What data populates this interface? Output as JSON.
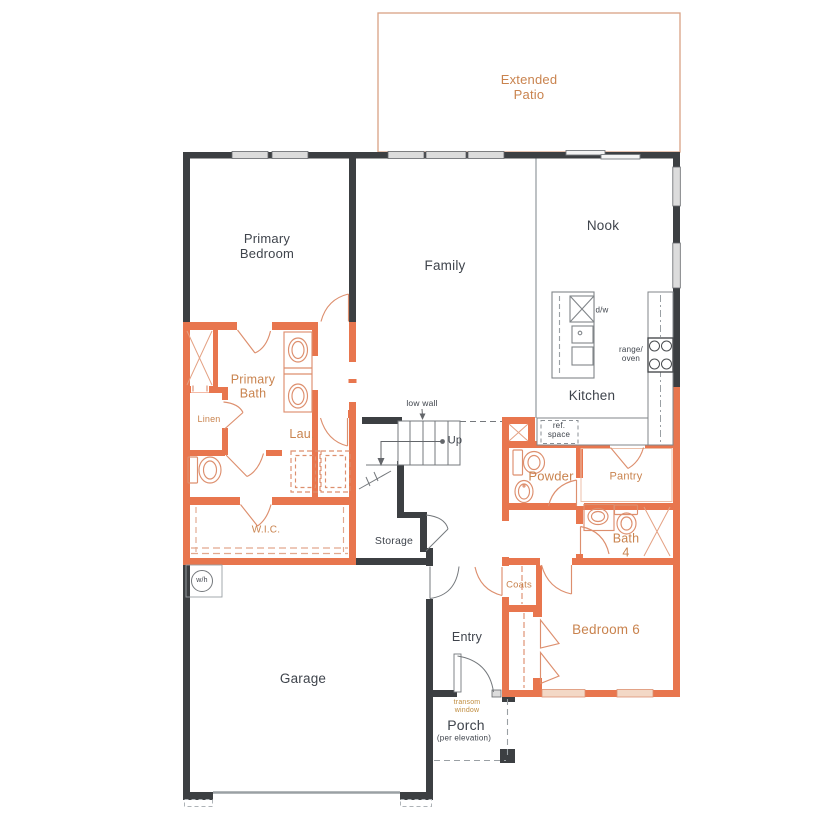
{
  "title": "Single-story floor plan",
  "colors": {
    "wall_dark": "#3c3f42",
    "wall_accent": "#e8764e",
    "fixture_accent": "#dd8f6e",
    "accent_label": "#c9834e",
    "dark_label": "#3f444c",
    "patio_outline": "#d9a284",
    "window_gray": "#dcdcdc",
    "window_tan": "#f3d8c6"
  },
  "labels": {
    "extended_patio": "Extended\nPatio",
    "primary_bedroom": "Primary\nBedroom",
    "family": "Family",
    "nook": "Nook",
    "kitchen": "Kitchen",
    "primary_bath": "Primary\nBath",
    "linen": "Linen",
    "laundry": "Lau.",
    "wic": "W.I.C.",
    "storage": "Storage",
    "powder": "Powder",
    "pantry": "Pantry",
    "bath4": "Bath\n4",
    "coats": "Coats",
    "bedroom6": "Bedroom 6",
    "entry": "Entry",
    "garage": "Garage",
    "porch": "Porch",
    "porch_note": "(per elevation)",
    "transom_window": "transom\nwindow",
    "up": "Up",
    "low_wall": "low wall",
    "dishwasher": "d/w",
    "range_oven": "range/\noven",
    "ref_space": "ref.\nspace",
    "water_heater": "w/h"
  }
}
